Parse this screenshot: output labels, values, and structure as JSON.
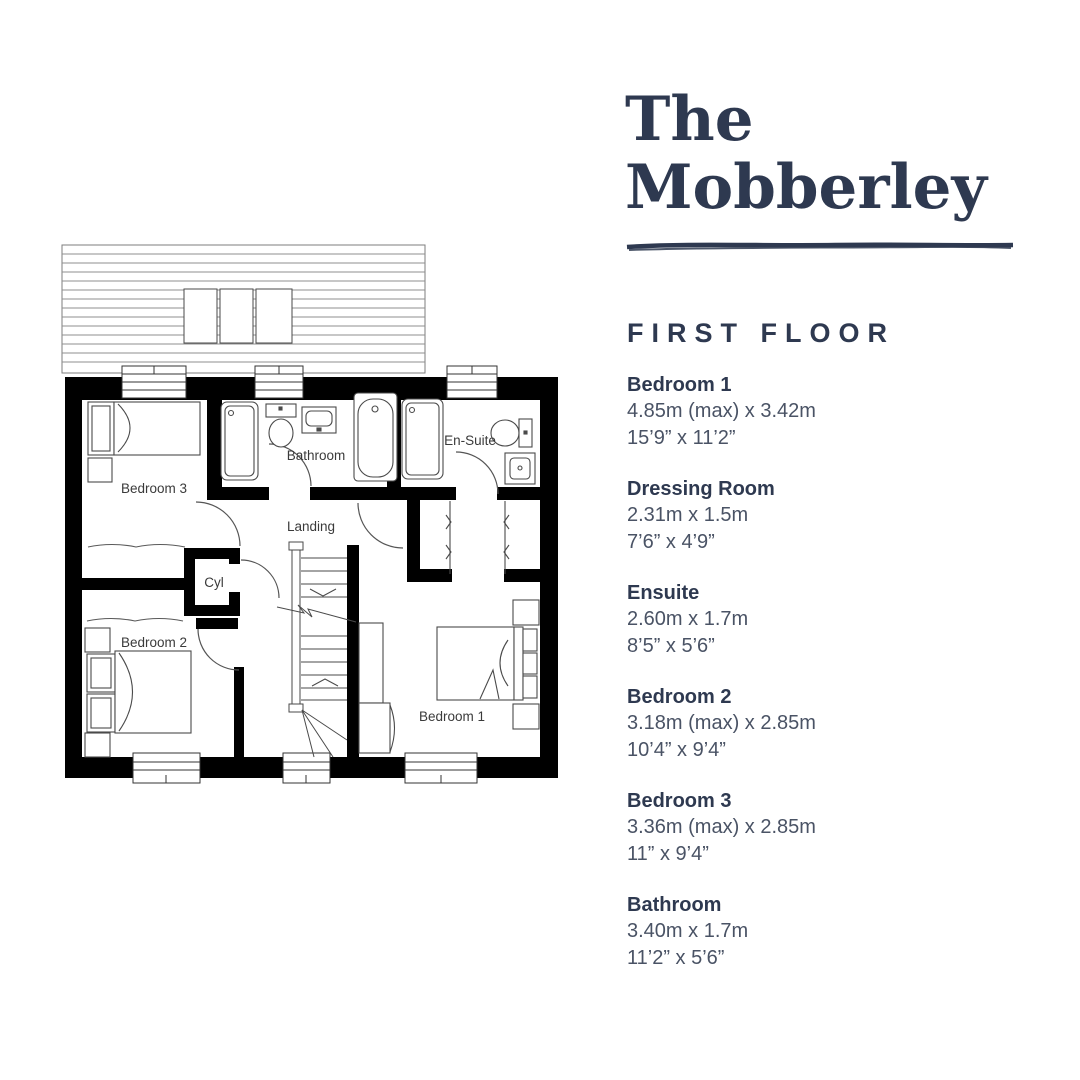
{
  "panel": {
    "title_line1": "The",
    "title_line2": "Mobberley",
    "floor_label": "FIRST FLOOR",
    "accent_color": "#2e3950",
    "rooms": [
      {
        "name": "Bedroom 1",
        "metric": "4.85m (max) x 3.42m",
        "imperial": "15’9” x 11’2”"
      },
      {
        "name": "Dressing Room",
        "metric": "2.31m x 1.5m",
        "imperial": "7’6” x 4’9”"
      },
      {
        "name": "Ensuite",
        "metric": "2.60m x 1.7m",
        "imperial": "8’5” x 5’6”"
      },
      {
        "name": "Bedroom 2",
        "metric": "3.18m (max) x 2.85m",
        "imperial": "10’4” x 9’4”"
      },
      {
        "name": "Bedroom 3",
        "metric": "3.36m (max) x 2.85m",
        "imperial": "11” x 9’4”"
      },
      {
        "name": "Bathroom",
        "metric": "3.40m x 1.7m",
        "imperial": "11’2” x 5’6”"
      }
    ]
  },
  "plan": {
    "labels": {
      "bedroom1": "Bedroom 1",
      "bedroom2": "Bedroom 2",
      "bedroom3": "Bedroom 3",
      "bathroom": "Bathroom",
      "ensuite": "En-Suite",
      "landing": "Landing",
      "cyl": "Cyl"
    }
  }
}
